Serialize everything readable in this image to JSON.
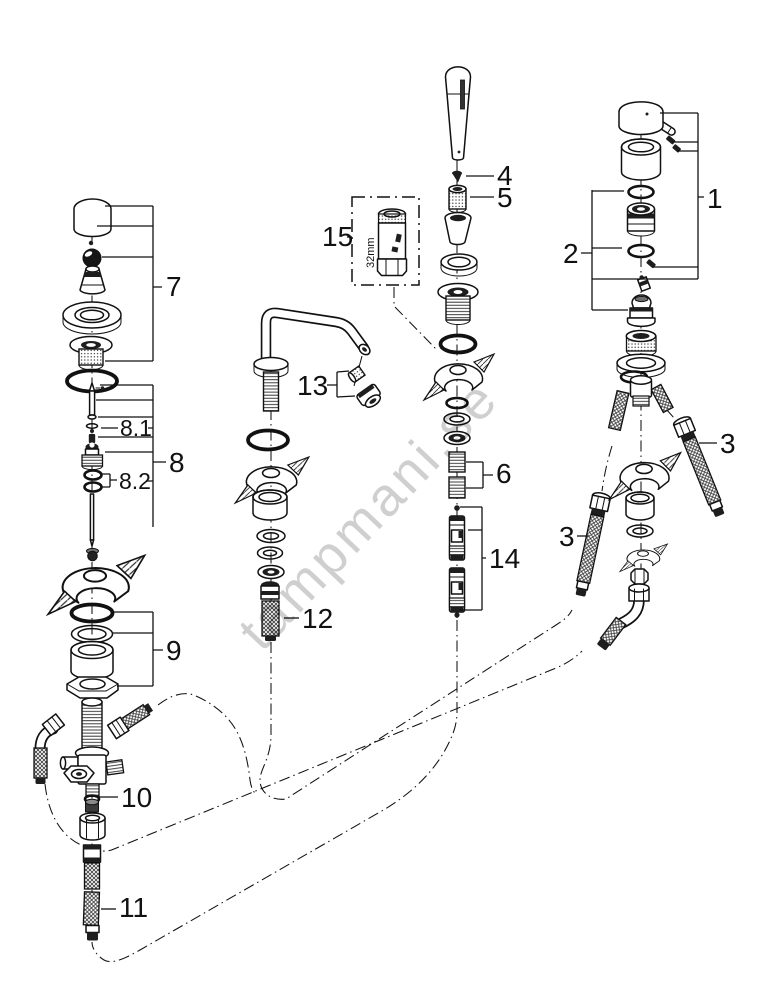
{
  "diagram": {
    "watermark": "tampmani.se",
    "tool_size_label": "32mm",
    "part_labels": {
      "p1": "1",
      "p2": "2",
      "p3_right": "3",
      "p3_left": "3",
      "p4": "4",
      "p5": "5",
      "p6": "6",
      "p7": "7",
      "p8": "8",
      "p8_1": "8.1",
      "p8_2": "8.2",
      "p9": "9",
      "p10": "10",
      "p11": "11",
      "p12": "12",
      "p13": "13",
      "p14": "14",
      "p15": "15"
    },
    "colors": {
      "line": "#111111",
      "watermark": "#c7c7c7",
      "background": "#ffffff"
    }
  }
}
